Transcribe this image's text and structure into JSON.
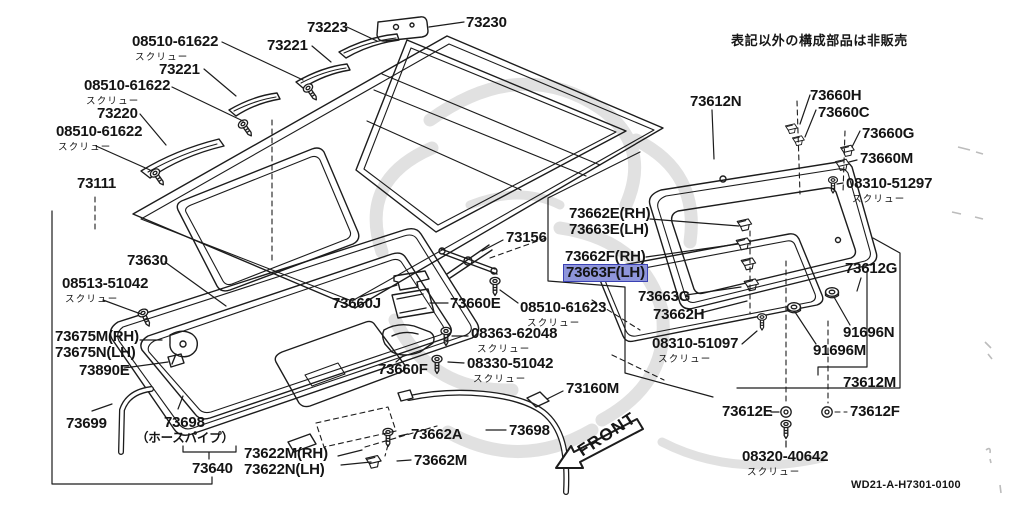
{
  "meta": {
    "background": "#ffffff",
    "ink": "#1c1c1c",
    "watermark": "#d7d7d7",
    "highlight_fill": "#8e95da",
    "highlight_border": "#3a41b3"
  },
  "note": "表記以外の構成部品は非販売",
  "drawing_code": "WD21-A-H7301-0100",
  "front_label": "FRONT",
  "labels": [
    {
      "name": "08510-61622-1",
      "x": 132,
      "y": 34,
      "lines": [
        "08510-61622"
      ],
      "sub": "スクリュー",
      "subdx": 3
    },
    {
      "name": "73221-1",
      "x": 159,
      "y": 62,
      "lines": [
        "73221"
      ]
    },
    {
      "name": "08510-61622-2",
      "x": 84,
      "y": 78,
      "lines": [
        "08510-61622"
      ],
      "sub": "スクリュー",
      "subdx": 2
    },
    {
      "name": "73220",
      "x": 97,
      "y": 106,
      "lines": [
        "73220"
      ]
    },
    {
      "name": "08510-61622-3",
      "x": 56,
      "y": 124,
      "lines": [
        "08510-61622"
      ],
      "sub": "スクリュー",
      "subdx": 2
    },
    {
      "name": "73111",
      "x": 77,
      "y": 176,
      "lines": [
        "73111"
      ]
    },
    {
      "name": "73221-2",
      "x": 267,
      "y": 38,
      "lines": [
        "73221"
      ]
    },
    {
      "name": "73223",
      "x": 307,
      "y": 20,
      "lines": [
        "73223"
      ]
    },
    {
      "name": "73230",
      "x": 466,
      "y": 15,
      "lines": [
        "73230"
      ]
    },
    {
      "name": "73612N",
      "x": 690,
      "y": 94,
      "lines": [
        "73612N"
      ]
    },
    {
      "name": "73660H",
      "x": 810,
      "y": 88,
      "lines": [
        "73660H"
      ]
    },
    {
      "name": "73660C",
      "x": 818,
      "y": 105,
      "lines": [
        "73660C"
      ]
    },
    {
      "name": "73660G",
      "x": 862,
      "y": 126,
      "lines": [
        "73660G"
      ]
    },
    {
      "name": "73660M",
      "x": 860,
      "y": 151,
      "lines": [
        "73660M"
      ]
    },
    {
      "name": "08310-51297",
      "x": 846,
      "y": 176,
      "lines": [
        "08310-51297"
      ],
      "sub": "スクリュー",
      "subdx": 6
    },
    {
      "name": "73662E-73663E",
      "x": 569,
      "y": 206,
      "lines": [
        "73662E(RH)",
        "73663E(LH)"
      ]
    },
    {
      "name": "73156",
      "x": 506,
      "y": 230,
      "lines": [
        "73156"
      ]
    },
    {
      "name": "73662F-73663F",
      "x": 565,
      "y": 249,
      "lines": [
        "73662F(RH)",
        "73663F(LH)"
      ],
      "hl": 1
    },
    {
      "name": "73663G",
      "x": 638,
      "y": 289,
      "lines": [
        "73663G"
      ]
    },
    {
      "name": "73662H",
      "x": 653,
      "y": 307,
      "lines": [
        "73662H"
      ]
    },
    {
      "name": "08510-61623",
      "x": 520,
      "y": 300,
      "lines": [
        "08510-61623"
      ],
      "sub": "スクリュー",
      "subdx": 7
    },
    {
      "name": "08363-62048",
      "x": 471,
      "y": 326,
      "lines": [
        "08363-62048"
      ],
      "sub": "スクリュー",
      "subdx": 6
    },
    {
      "name": "08330-51042",
      "x": 467,
      "y": 356,
      "lines": [
        "08330-51042"
      ],
      "sub": "スクリュー",
      "subdx": 6
    },
    {
      "name": "73660J",
      "x": 332,
      "y": 296,
      "lines": [
        "73660J"
      ]
    },
    {
      "name": "73660E",
      "x": 450,
      "y": 296,
      "lines": [
        "73660E"
      ]
    },
    {
      "name": "73660F",
      "x": 378,
      "y": 362,
      "lines": [
        "73660F"
      ]
    },
    {
      "name": "73630",
      "x": 127,
      "y": 253,
      "lines": [
        "73630"
      ]
    },
    {
      "name": "08513-51042",
      "x": 62,
      "y": 276,
      "lines": [
        "08513-51042"
      ],
      "sub": "スクリュー",
      "subdx": 3
    },
    {
      "name": "73675M-73675N",
      "x": 55,
      "y": 329,
      "lines": [
        "73675M(RH)",
        "73675N(LH)"
      ]
    },
    {
      "name": "73890E",
      "x": 79,
      "y": 363,
      "lines": [
        "73890E"
      ]
    },
    {
      "name": "73699",
      "x": 66,
      "y": 416,
      "lines": [
        "73699"
      ]
    },
    {
      "name": "73698-hose",
      "x": 164,
      "y": 415,
      "lines": [
        "73698"
      ]
    },
    {
      "name": "hose-pipe-note",
      "x": 136,
      "y": 430,
      "lines": [
        "（ホースパイプ）"
      ],
      "size": 12.5
    },
    {
      "name": "73640",
      "x": 192,
      "y": 461,
      "lines": [
        "73640"
      ]
    },
    {
      "name": "73622M-73622N",
      "x": 244,
      "y": 446,
      "lines": [
        "73622M(RH)",
        "73622N(LH)"
      ]
    },
    {
      "name": "73662A",
      "x": 411,
      "y": 427,
      "lines": [
        "73662A"
      ]
    },
    {
      "name": "73662M",
      "x": 414,
      "y": 453,
      "lines": [
        "73662M"
      ]
    },
    {
      "name": "73160M",
      "x": 566,
      "y": 381,
      "lines": [
        "73160M"
      ]
    },
    {
      "name": "73698-2",
      "x": 509,
      "y": 423,
      "lines": [
        "73698"
      ]
    },
    {
      "name": "08310-51097",
      "x": 652,
      "y": 336,
      "lines": [
        "08310-51097"
      ],
      "sub": "スクリュー",
      "subdx": 6
    },
    {
      "name": "73612G",
      "x": 845,
      "y": 261,
      "lines": [
        "73612G"
      ]
    },
    {
      "name": "91696N",
      "x": 843,
      "y": 325,
      "lines": [
        "91696N"
      ]
    },
    {
      "name": "91696M",
      "x": 813,
      "y": 343,
      "lines": [
        "91696M"
      ]
    },
    {
      "name": "73612M",
      "x": 843,
      "y": 375,
      "lines": [
        "73612M"
      ]
    },
    {
      "name": "73612E",
      "x": 722,
      "y": 404,
      "lines": [
        "73612E"
      ]
    },
    {
      "name": "73612F",
      "x": 850,
      "y": 404,
      "lines": [
        "73612F"
      ]
    },
    {
      "name": "08320-40642",
      "x": 742,
      "y": 449,
      "lines": [
        "08320-40642"
      ],
      "sub": "スクリュー",
      "subdx": 5
    }
  ]
}
